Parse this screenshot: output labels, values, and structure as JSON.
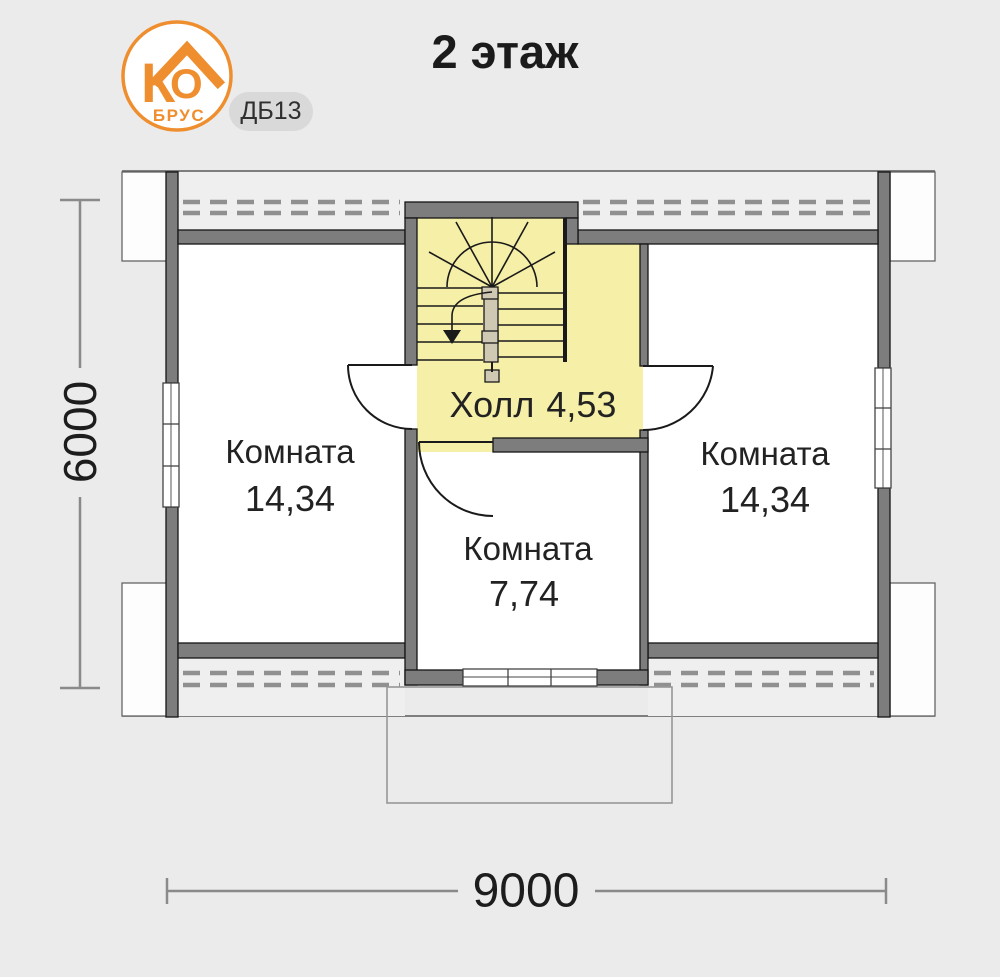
{
  "header": {
    "logo": {
      "letter1": "К",
      "letter2": "О",
      "brand": "БРУС"
    },
    "badge": "ДБ13",
    "title": "2 этаж"
  },
  "plan": {
    "hall": {
      "name": "Холл",
      "area": "4,53"
    },
    "rooms": [
      {
        "name": "Комната",
        "area": "14,34"
      },
      {
        "name": "Комната",
        "area": "14,34"
      },
      {
        "name": "Комната",
        "area": "7,74"
      }
    ],
    "dimensions": {
      "horizontal": "9000",
      "vertical": "6000"
    }
  },
  "colors": {
    "background": "#ebebeb",
    "wall": "#7d7d7d",
    "hall_highlight": "#f5efa8",
    "accent_orange": "#ef8e2e",
    "badge_background": "#d9d9d9",
    "dimension_line": "#8a8a8a",
    "text": "#1f1f1f"
  }
}
